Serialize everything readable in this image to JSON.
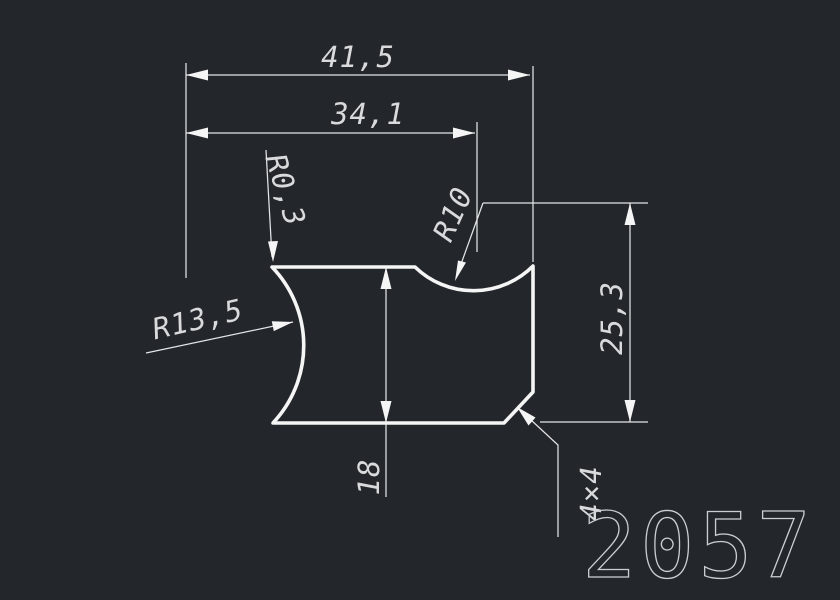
{
  "canvas": {
    "background_color": "#23272b",
    "geometry_line_color": "#f5f5f5",
    "dimension_line_color": "#e3e5e7",
    "dimension_text_color": "#d8dadc"
  },
  "dimensions": {
    "overall_width": "41,5",
    "secondary_width": "34,1",
    "corner_radius": "R0,3",
    "groove_radius": "R10",
    "side_radius": "R13,5",
    "right_height": "25,3",
    "body_height": "18",
    "chamfer": "4×4"
  },
  "part_number": "2057"
}
